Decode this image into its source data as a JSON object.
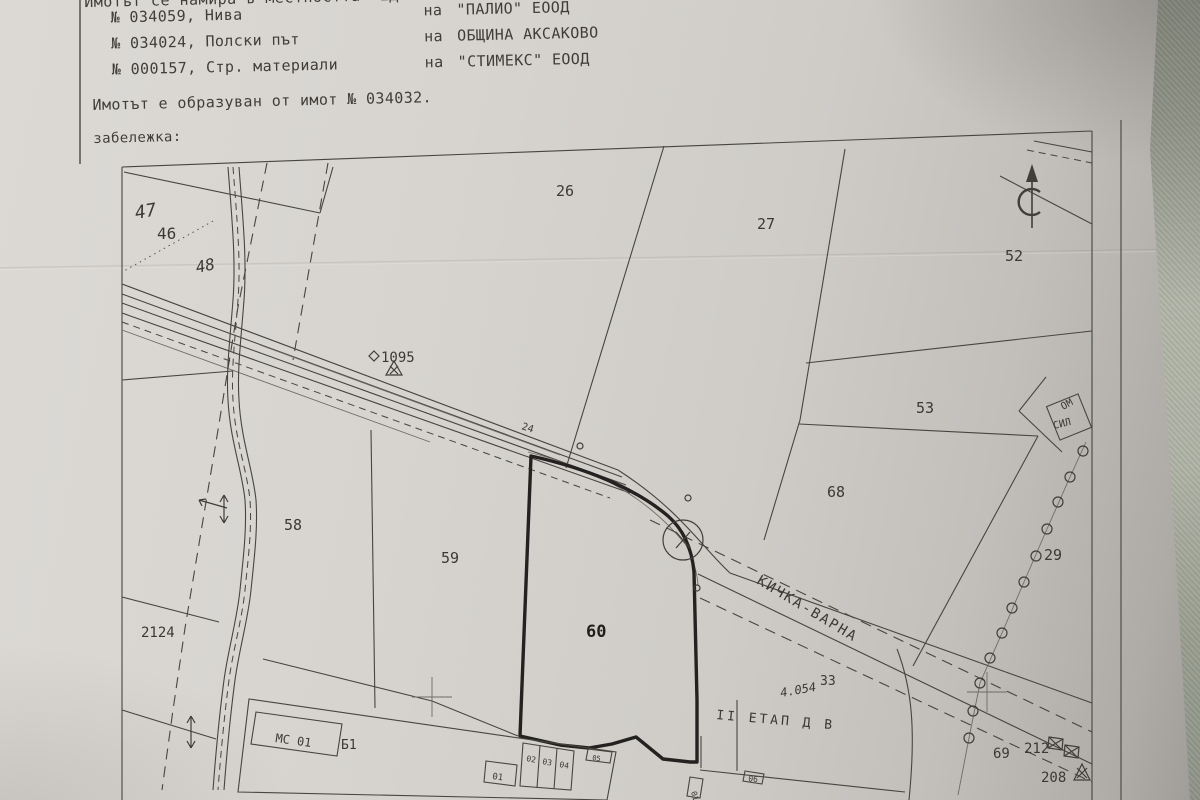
{
  "header": {
    "line1": "Имотът се намира в местността  ЕДИ КЕ",
    "rows": [
      {
        "left": "№ 034059, Нива",
        "mid": "на",
        "right": "\"ПАЛИО\" ЕООД"
      },
      {
        "left": "№ 034024, Полски път",
        "mid": "на",
        "right": "ОБЩИНА АКСАКОВО"
      },
      {
        "left": "№ 000157, Стр. материали",
        "mid": "на",
        "right": "\"СТИМЕКС\" ЕООД"
      }
    ],
    "formed_line": "Имотът е образуван от имот № 034032.",
    "note_label": "забележка:"
  },
  "map": {
    "highlighted_parcel": "60",
    "road_name": "КИЧКА-ВАРНА",
    "stage_note": "II ЕТАП Д В",
    "north_symbol": "north-arrow-C",
    "labels": [
      {
        "t": "47",
        "x": 136,
        "y": 219,
        "s": 18,
        "r": -10,
        "i": 1
      },
      {
        "t": "46",
        "x": 157,
        "y": 239,
        "s": 16
      },
      {
        "t": "48",
        "x": 197,
        "y": 273,
        "s": 16,
        "r": -12,
        "i": 1
      },
      {
        "t": "26",
        "x": 556,
        "y": 196,
        "s": 15
      },
      {
        "t": "27",
        "x": 757,
        "y": 229,
        "s": 15
      },
      {
        "t": "52",
        "x": 1005,
        "y": 261,
        "s": 15
      },
      {
        "t": "53",
        "x": 916,
        "y": 413,
        "s": 15
      },
      {
        "t": "68",
        "x": 827,
        "y": 497,
        "s": 15
      },
      {
        "t": "29",
        "x": 1044,
        "y": 560,
        "s": 15
      },
      {
        "t": "58",
        "x": 284,
        "y": 530,
        "s": 15
      },
      {
        "t": "59",
        "x": 441,
        "y": 563,
        "s": 15
      },
      {
        "t": "60",
        "x": 586,
        "y": 637,
        "s": 17,
        "b": 1
      },
      {
        "t": "2124",
        "x": 141,
        "y": 637,
        "s": 14
      },
      {
        "t": "1095",
        "x": 381,
        "y": 362,
        "s": 14
      },
      {
        "t": "24",
        "x": 521,
        "y": 429,
        "s": 10,
        "r": 18
      },
      {
        "t": "33",
        "x": 820,
        "y": 685,
        "s": 13
      },
      {
        "t": "4.054",
        "x": 781,
        "y": 697,
        "s": 12,
        "i": 1,
        "r": -10
      },
      {
        "t": "Б1",
        "x": 341,
        "y": 749,
        "s": 13
      },
      {
        "t": "МС 01",
        "x": 275,
        "y": 742,
        "s": 12,
        "r": 8
      },
      {
        "t": "69",
        "x": 993,
        "y": 758,
        "s": 14
      },
      {
        "t": "212",
        "x": 1024,
        "y": 753,
        "s": 14
      },
      {
        "t": "208",
        "x": 1041,
        "y": 782,
        "s": 14
      },
      {
        "t": "II ЕТАП Д В",
        "x": 716,
        "y": 719,
        "s": 13,
        "r": 5,
        "ls": 3
      },
      {
        "t": "КИЧКА-ВАРНА",
        "x": 756,
        "y": 583,
        "s": 14,
        "r": 31,
        "ls": 2
      },
      {
        "t": "01",
        "x": 492,
        "y": 779,
        "s": 9,
        "r": 8
      },
      {
        "t": "02",
        "x": 526,
        "y": 761,
        "s": 8,
        "r": 10
      },
      {
        "t": "03",
        "x": 542,
        "y": 764,
        "s": 8,
        "r": 10
      },
      {
        "t": "04",
        "x": 559,
        "y": 767,
        "s": 8,
        "r": 10
      },
      {
        "t": "05",
        "x": 592,
        "y": 760,
        "s": 7,
        "r": 8
      },
      {
        "t": "01",
        "x": 691,
        "y": 792,
        "s": 8,
        "r": 75
      },
      {
        "t": "06",
        "x": 748,
        "y": 781,
        "s": 8,
        "r": 8
      },
      {
        "t": "ОМ",
        "x": 1063,
        "y": 410,
        "s": 10,
        "r": -28
      },
      {
        "t": "СИЛ",
        "x": 1054,
        "y": 429,
        "s": 10,
        "r": -14
      }
    ]
  }
}
